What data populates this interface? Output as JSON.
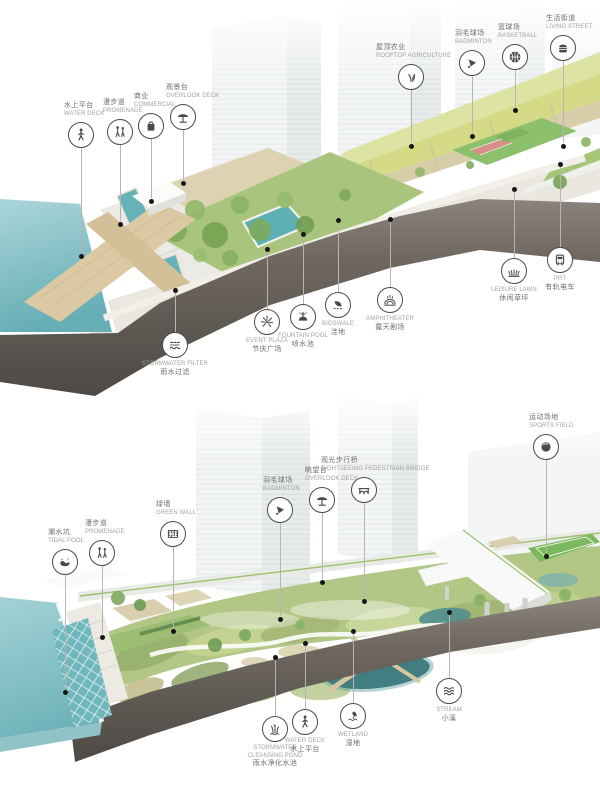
{
  "colors": {
    "water": "#6fb3ba",
    "pool": "#5fb0b4",
    "vegetation": "#a9c47d",
    "farm_roof": "#d4da86",
    "wood_deck": "#dbc9a3",
    "earth_section": "#5d5751",
    "label_chinese": "#6e6e6e",
    "label_english": "#a3a29f",
    "leader_line": "#b6b5b2",
    "leader_dot": "#161616"
  },
  "top": {
    "callouts": [
      {
        "zh": "水上平台",
        "en": "WATER DECK",
        "icon": "pedestrian-icon"
      },
      {
        "zh": "漫步道",
        "en": "PROMENADE",
        "icon": "walkers-icon"
      },
      {
        "zh": "商业",
        "en": "COMMERCIAL",
        "icon": "shopping-bag-icon"
      },
      {
        "zh": "观景台",
        "en": "OVERLOOK DECK",
        "icon": "umbrella-icon"
      },
      {
        "zh": "屋顶农业",
        "en": "ROOFTOP AGRICULTURE",
        "icon": "sprout-icon"
      },
      {
        "zh": "羽毛球场",
        "en": "BADMINTON",
        "icon": "shuttlecock-icon"
      },
      {
        "zh": "篮球场",
        "en": "BASKETBALL",
        "icon": "basketball-icon"
      },
      {
        "zh": "生活街道",
        "en": "LIVING STREET",
        "icon": "street-food-icon"
      },
      {
        "en": "LEISURE LAWN",
        "zh": "休闲草坪",
        "icon": "lawn-icon"
      },
      {
        "en": "PRT",
        "zh": "有轨电车",
        "icon": "tram-icon"
      },
      {
        "en": "STORMWATER FILTER",
        "zh": "雨水过滤",
        "icon": "water-filter-icon"
      },
      {
        "en": "EVENT PLAZA",
        "zh": "节庆广场",
        "icon": "fireworks-icon"
      },
      {
        "en": "FOUNTAIN POOL",
        "zh": "喷水池",
        "icon": "fountain-icon"
      },
      {
        "en": "BIOSWALE",
        "zh": "洼地",
        "icon": "bioswale-icon"
      },
      {
        "en": "AMPHITHEATER",
        "zh": "露天剧场",
        "icon": "amphitheater-icon"
      }
    ]
  },
  "bottom": {
    "callouts": [
      {
        "zh": "潮水坑",
        "en": "TIDAL POOL",
        "icon": "tidal-pool-icon"
      },
      {
        "zh": "漫步道",
        "en": "PROMENADE",
        "icon": "walkers-icon"
      },
      {
        "zh": "绿墙",
        "en": "GREEN WALL",
        "icon": "green-wall-icon"
      },
      {
        "zh": "羽毛球场",
        "en": "BADMINTON",
        "icon": "shuttlecock-icon"
      },
      {
        "zh": "眺望台",
        "en": "OVERLOOK DECK",
        "icon": "umbrella-icon"
      },
      {
        "zh": "观光步行桥",
        "en": "SIGHTSEEING PEDESTRIAN BRIDGE",
        "icon": "bridge-icon"
      },
      {
        "zh": "运动场地",
        "en": "SPORTS FIELD",
        "icon": "sports-ball-icon"
      },
      {
        "en": "STORMWATER CLEANSING POND",
        "zh": "雨水净化水池",
        "icon": "reeds-icon"
      },
      {
        "en": "WATER DECK",
        "zh": "水上平台",
        "icon": "pedestrian-icon"
      },
      {
        "en": "WETLAND",
        "zh": "湿地",
        "icon": "wetland-icon"
      },
      {
        "en": "STREAM",
        "zh": "小溪",
        "icon": "stream-icon"
      }
    ]
  }
}
